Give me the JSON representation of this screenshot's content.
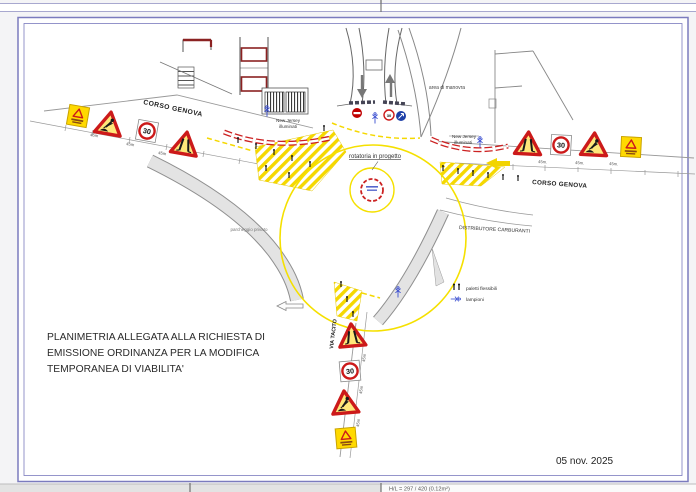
{
  "document": {
    "note_lines": [
      "PLANIMETRIA ALLEGATA ALLA RICHIESTA DI",
      "EMISSIONE ORDINANZA PER LA MODIFICA",
      "TEMPORANEA DI VIABILITA'"
    ],
    "date": "05 nov. 2025",
    "status_bar": {
      "sheet_info": "H/L = 297 / 420 (0.12m²)"
    }
  },
  "map": {
    "streets": {
      "corso_genova_west": "CORSO GENOVA",
      "corso_genova_east": "CORSO GENOVA",
      "via_tacito": "VIA TACITO"
    },
    "labels": {
      "area_manovra": "area di manovra",
      "rotatoria": "rotatoria in progetto",
      "distributore": "DISTRIBUTORE CARBURANTI",
      "parcheggio": "parcheggio privato",
      "new_jersey_line1": "New Jersey",
      "new_jersey_line2": "illuminati"
    },
    "legend": {
      "bollards": "paletti flessibili",
      "lamps": "lampioni"
    },
    "signs": {
      "speed_limit": "30",
      "distance_west": "45m",
      "distance_east": "45m.",
      "distance_south": "45m"
    },
    "colors": {
      "frame": "#7b7bbe",
      "work_yellow": "#f5d800",
      "sign_red": "#cc1a1a",
      "barrier_red": "#cc2222",
      "building_accent": "#8b2222",
      "lamp_blue": "#3a4ed0"
    }
  }
}
